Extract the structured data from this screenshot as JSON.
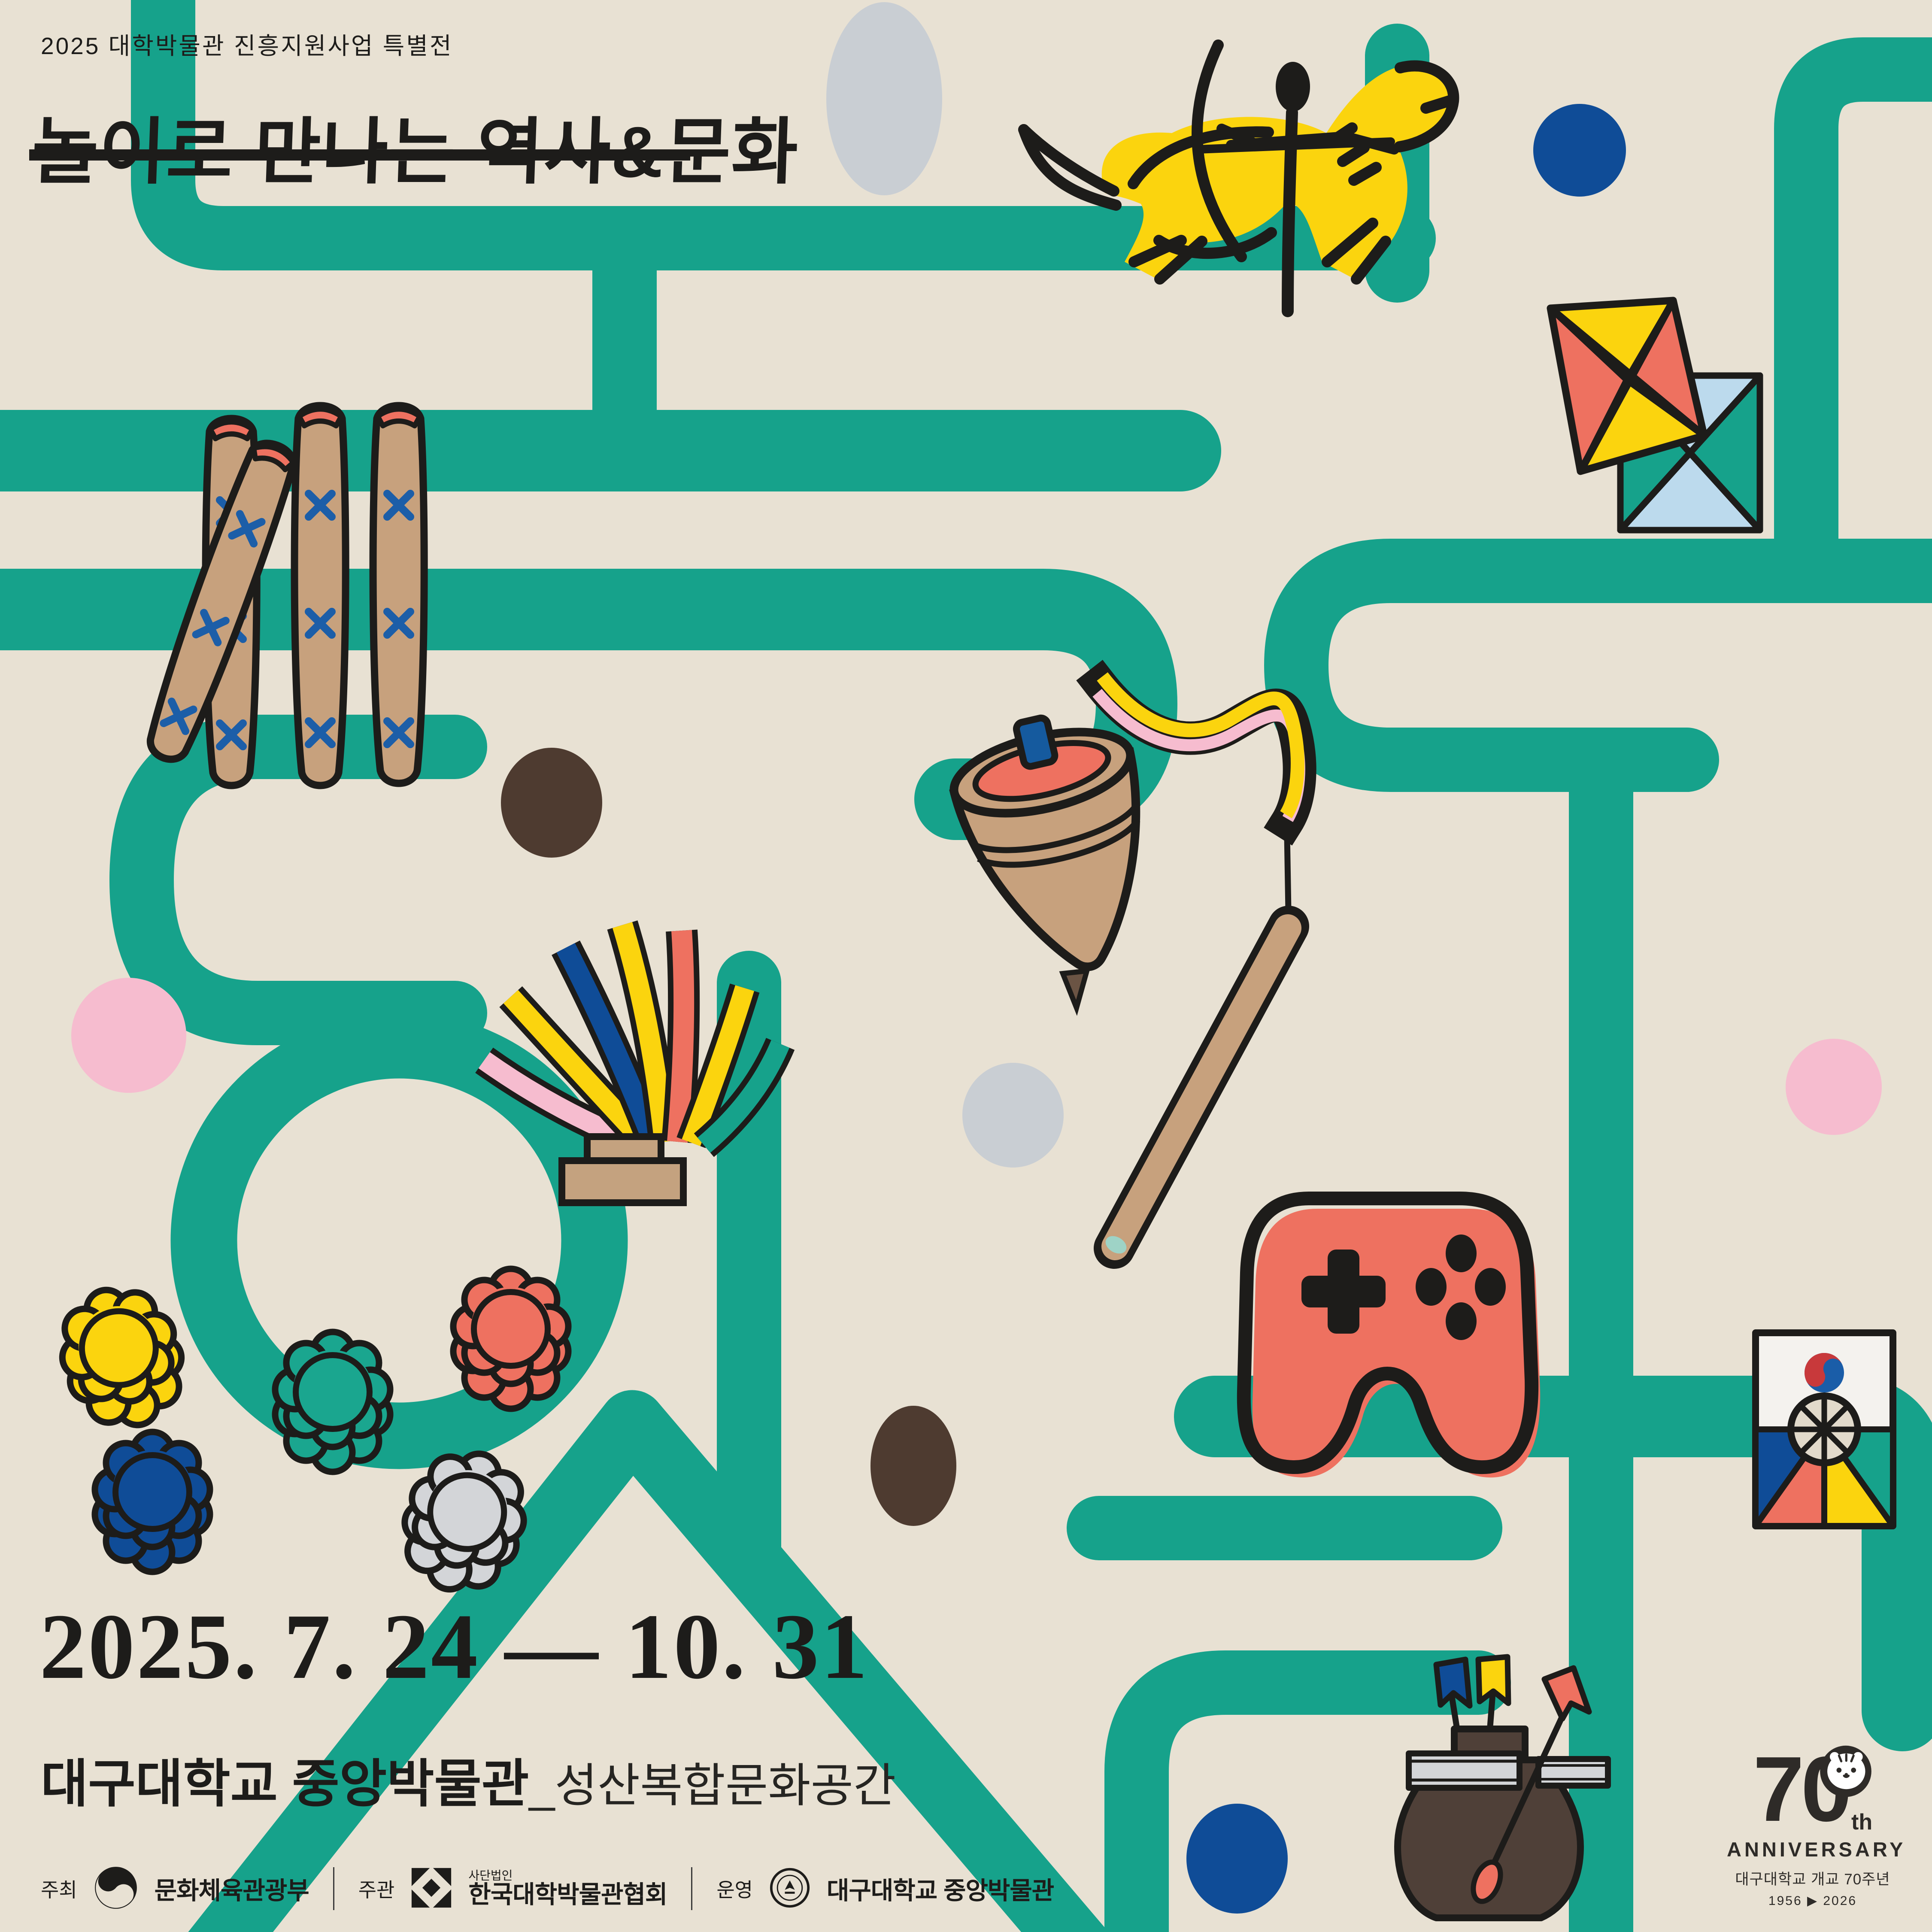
{
  "poster": {
    "eyebrow": "2025 대학박물관 진흥지원사업 특별전",
    "title": "놀이로 만나는 역사&문화",
    "date_range": "2025. 7. 24 — 10. 31",
    "venue_main": "대구대학교 중앙박물관",
    "venue_sub": "_성산복합문화공간"
  },
  "footer": {
    "host_label": "주최",
    "host_name": "문화체육관광부",
    "organizer_label": "주관",
    "organizer_prefix": "사단법인",
    "organizer_name": "한국대학박물관협회",
    "operator_label": "운영",
    "operator_name": "대구대학교 중앙박물관"
  },
  "anniversary": {
    "number": "70",
    "suffix": "th",
    "word": "ANNIVERSARY",
    "line1": "대구대학교 개교 70주년",
    "years": "1956 ▶ 2026"
  },
  "illustrations": {
    "horse_archer": "goguryeo-mounted-archer",
    "kites": "paired-square-kites",
    "yut_sticks": "yut-nori-sticks",
    "spinning_top": "spinning-top-with-whip",
    "jegi": "jegi-shuttlecock-ribbons",
    "controller": "game-controller",
    "game_pieces": "flower-game-pieces",
    "shield_kite": "korean-shield-kite",
    "tuho": "tuho-arrow-pot"
  },
  "colors": {
    "background": "#E8E1D3",
    "teal": "#16A28B",
    "yellow": "#FBD40E",
    "coral": "#EE7160",
    "pink": "#F6BCCF",
    "navy": "#0F4C97",
    "light_blue": "#BCDAED",
    "tan": "#C7A17D",
    "brown": "#4F4038",
    "black": "#1D1C1A"
  }
}
